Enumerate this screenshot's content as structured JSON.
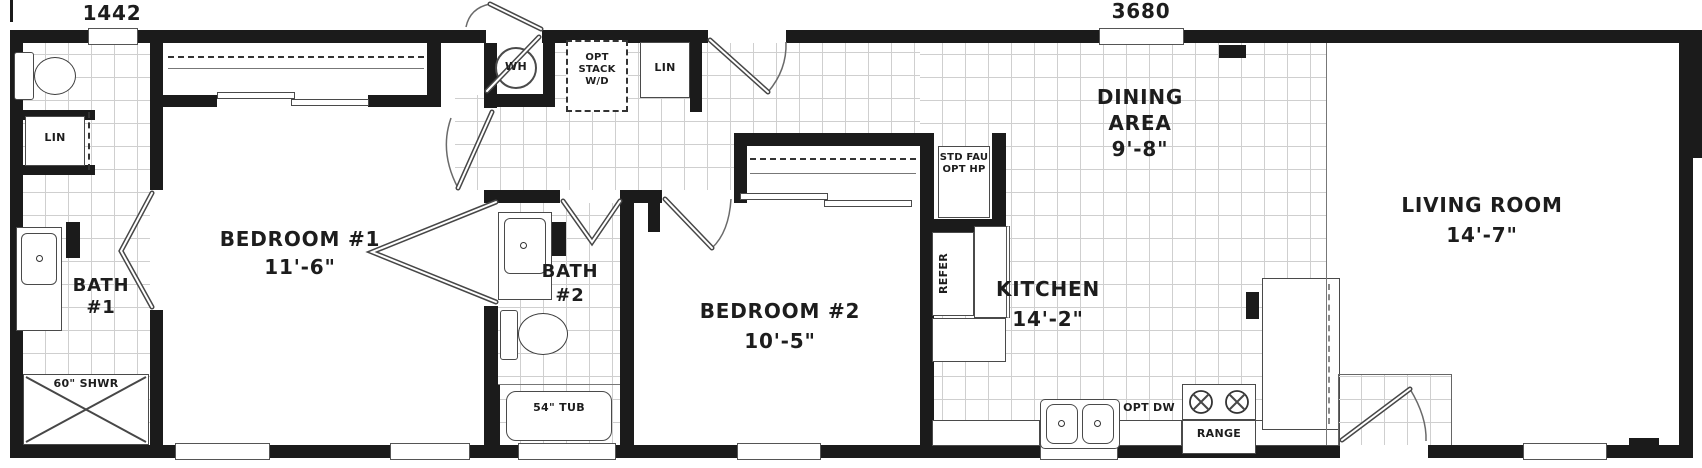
{
  "dimensions": {
    "left": "1442",
    "right": "3680"
  },
  "rooms": {
    "bath1": {
      "l1": "BATH",
      "l2": "#1"
    },
    "bedroom1": {
      "name": "BEDROOM #1",
      "size": "11'-6\""
    },
    "bath2": {
      "l1": "BATH",
      "l2": "#2"
    },
    "bedroom2": {
      "name": "BEDROOM #2",
      "size": "10'-5\""
    },
    "dining": {
      "l1": "DINING",
      "l2": "AREA",
      "size": "9'-8\""
    },
    "kitchen": {
      "name": "KITCHEN",
      "size": "14'-2\""
    },
    "living": {
      "name": "LIVING ROOM",
      "size": "14'-7\""
    }
  },
  "fixtures": {
    "water_heater": "WH",
    "opt_stack_l1": "OPT",
    "opt_stack_l2": "STACK",
    "opt_stack_l3": "W/D",
    "linen_hall": "LIN",
    "linen_bath1": "LIN",
    "fau_l1": "STD FAU",
    "fau_l2": "OPT HP",
    "refrigerator": "REFER",
    "shower": "60\" SHWR",
    "tub": "54\" TUB",
    "dishwasher": "OPT DW",
    "range": "RANGE"
  },
  "colors": {
    "wall": "#1b1b1b",
    "tile_line": "#cfcfcf",
    "ink": "#1d1d1d"
  }
}
